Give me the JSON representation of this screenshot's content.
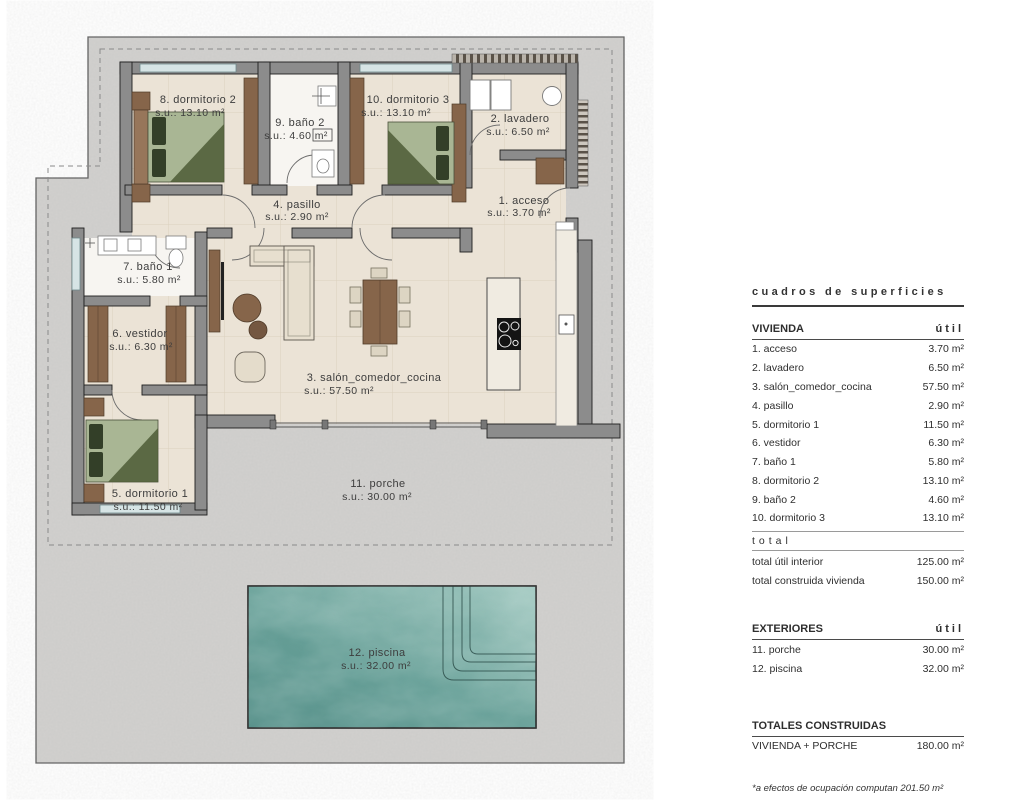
{
  "plan": {
    "rooms": [
      {
        "name": "8. dormitorio 2",
        "area": "s.u.: 13.10 m²"
      },
      {
        "name": "9. baño 2",
        "area": "s.u.: 4.60 m²"
      },
      {
        "name": "10. dormitorio 3",
        "area": "s.u.: 13.10 m²"
      },
      {
        "name": "2. lavadero",
        "area": "s.u.: 6.50 m²"
      },
      {
        "name": "4. pasillo",
        "area": "s.u.: 2.90 m²"
      },
      {
        "name": "1. acceso",
        "area": "s.u.: 3.70 m²"
      },
      {
        "name": "7. baño 1",
        "area": "s.u.: 5.80 m²"
      },
      {
        "name": "6. vestidor",
        "area": "s.u.: 6.30 m²"
      },
      {
        "name": "3. salón_comedor_cocina",
        "area": "s.u.: 57.50 m²"
      },
      {
        "name": "5. dormitorio 1",
        "area": "s.u.: 11.50 m²"
      },
      {
        "name": "11. porche",
        "area": "s.u.: 30.00 m²"
      },
      {
        "name": "12. piscina",
        "area": "s.u.: 32.00 m²"
      }
    ]
  },
  "panel": {
    "title": "cuadros de superficies",
    "vivienda": {
      "header": "VIVIENDA",
      "col": "útil",
      "rows": [
        {
          "name": "1. acceso",
          "value": "3.70 m²"
        },
        {
          "name": "2. lavadero",
          "value": "6.50 m²"
        },
        {
          "name": "3. salón_comedor_cocina",
          "value": "57.50 m²"
        },
        {
          "name": "4. pasillo",
          "value": "2.90 m²"
        },
        {
          "name": "5. dormitorio 1",
          "value": "11.50 m²"
        },
        {
          "name": "6. vestidor",
          "value": "6.30 m²"
        },
        {
          "name": "7. baño 1",
          "value": "5.80 m²"
        },
        {
          "name": "8. dormitorio 2",
          "value": "13.10 m²"
        },
        {
          "name": "9. baño 2",
          "value": "4.60 m²"
        },
        {
          "name": "10. dormitorio 3",
          "value": "13.10 m²"
        }
      ]
    },
    "total_label": "total",
    "totals": [
      {
        "name": "total útil interior",
        "value": "125.00 m²"
      },
      {
        "name": "total construida vivienda",
        "value": "150.00 m²"
      }
    ],
    "exteriores": {
      "header": "EXTERIORES",
      "col": "útil",
      "rows": [
        {
          "name": "11. porche",
          "value": "30.00 m²"
        },
        {
          "name": "12. piscina",
          "value": "32.00 m²"
        }
      ]
    },
    "totales_construidas": {
      "header": "TOTALES CONSTRUIDAS",
      "rows": [
        {
          "name": "VIVIENDA + PORCHE",
          "value": "180.00 m²"
        }
      ]
    },
    "footnote": "*a efectos de ocupación computan 201.50 m²"
  },
  "colors": {
    "terrain": "#d2d1cf",
    "wall": "#8c8c8c",
    "floor": "#ebe3d6",
    "wood": "#86654a",
    "bed_green": "#a9b694",
    "pool_teal": "#5f948d",
    "text": "#3d3d3d"
  }
}
